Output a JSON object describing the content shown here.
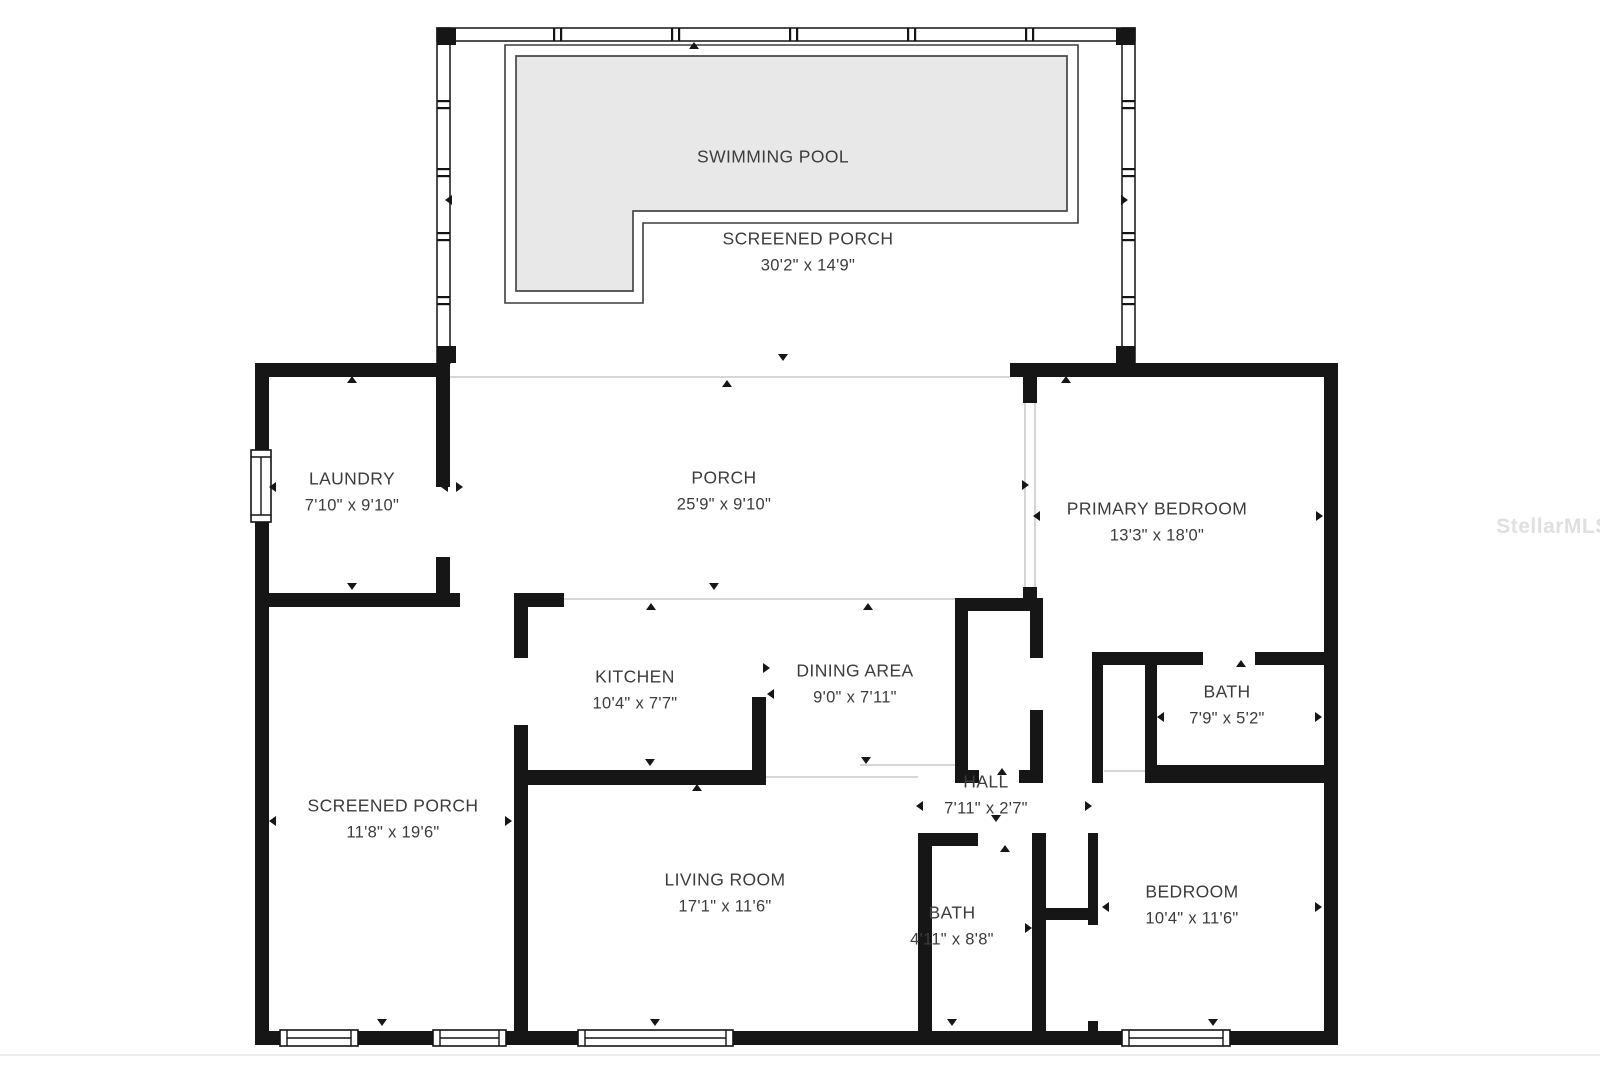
{
  "floor_plan": {
    "watermark": "StellarMLS",
    "rooms": {
      "swimming_pool": {
        "name": "SWIMMING POOL",
        "dims": ""
      },
      "screened_porch_pool": {
        "name": "SCREENED PORCH",
        "dims": "30'2\" x 14'9\""
      },
      "laundry": {
        "name": "LAUNDRY",
        "dims": "7'10\" x 9'10\""
      },
      "porch": {
        "name": "PORCH",
        "dims": "25'9\" x 9'10\""
      },
      "primary_bedroom": {
        "name": "PRIMARY BEDROOM",
        "dims": "13'3\" x 18'0\""
      },
      "kitchen": {
        "name": "KITCHEN",
        "dims": "10'4\" x 7'7\""
      },
      "dining_area": {
        "name": "DINING AREA",
        "dims": "9'0\" x 7'11\""
      },
      "bath_primary": {
        "name": "BATH",
        "dims": "7'9\" x 5'2\""
      },
      "hall": {
        "name": "HALL",
        "dims": "7'11\" x 2'7\""
      },
      "screened_porch_side": {
        "name": "SCREENED PORCH",
        "dims": "11'8\" x 19'6\""
      },
      "living_room": {
        "name": "LIVING ROOM",
        "dims": "17'1\" x 11'6\""
      },
      "bath_hall": {
        "name": "BATH",
        "dims": "4'11\" x 8'8\""
      },
      "bedroom": {
        "name": "BEDROOM",
        "dims": "10'4\" x 11'6\""
      }
    },
    "colors": {
      "wall": "#161616",
      "pool_fill": "#e8e8e8",
      "pool_stroke": "#474747",
      "open_edge": "#d6d6d6",
      "label_text": "#3c3c3c"
    }
  }
}
